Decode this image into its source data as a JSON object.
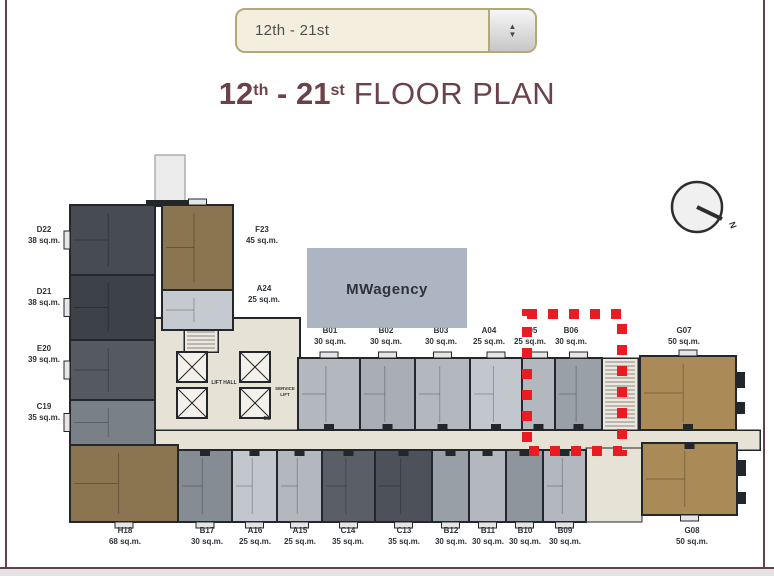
{
  "selector": {
    "value": "12th - 21st",
    "up_icon": "▲",
    "down_icon": "▼"
  },
  "title": {
    "bold_1": "12",
    "sup_1": "th",
    "dash": " - ",
    "bold_2": "21",
    "sup_2": "st",
    "regular": "FLOOR PLAN"
  },
  "watermark": {
    "x": 307,
    "y": 248,
    "w": 160,
    "h": 80,
    "text": "MWagency",
    "fill": "#a8afbd",
    "text_color": "#ffffff"
  },
  "compass": {
    "cx": 697,
    "cy": 207,
    "r": 25,
    "nx": 722,
    "ny": 219,
    "label": "N",
    "label_x": 730,
    "label_y": 226,
    "label_rot": 70
  },
  "colors": {
    "wall": "#23262b",
    "core": "#e7e2d6",
    "stair_bg": "#ece8dd",
    "bump": "#e6e6e6",
    "highlight": "#ec1a21",
    "accent_maroon": "#6d4149",
    "dropdown_border": "#b4a77c"
  },
  "floor_plan": {
    "core": {
      "x": 150,
      "y": 318,
      "w": 150,
      "h": 134
    },
    "corridor": {
      "x": 150,
      "y": 430,
      "w": 610,
      "h": 20
    },
    "open_area": {
      "x": 586,
      "y": 448,
      "w": 56,
      "h": 74
    },
    "stairs": [
      {
        "x": 184,
        "y": 320,
        "w": 34,
        "h": 32
      },
      {
        "x": 602,
        "y": 358,
        "w": 36,
        "h": 72
      }
    ],
    "lifts": [
      {
        "x": 177,
        "y": 352
      },
      {
        "x": 177,
        "y": 388
      },
      {
        "x": 240,
        "y": 352
      },
      {
        "x": 240,
        "y": 388
      }
    ],
    "lift_size": 30,
    "core_labels": [
      {
        "text": "LIFT HALL",
        "x": 224,
        "y": 384,
        "size": 5
      },
      {
        "text": "SERVICE",
        "x": 285,
        "y": 390,
        "size": 4.5
      },
      {
        "text": "LIFT",
        "x": 285,
        "y": 396,
        "size": 4.5
      },
      {
        "text": "GB",
        "x": 267,
        "y": 420,
        "size": 5
      }
    ],
    "units": [
      {
        "id": "D22",
        "area": "38 sq.m.",
        "x": 70,
        "y": 205,
        "w": 85,
        "h": 70,
        "fill": "#474b52",
        "lx": 44,
        "ly": 232,
        "edge": "l"
      },
      {
        "id": "D21",
        "area": "38 sq.m.",
        "x": 70,
        "y": 275,
        "w": 85,
        "h": 65,
        "fill": "#3d4148",
        "lx": 44,
        "ly": 294,
        "edge": "l"
      },
      {
        "id": "E20",
        "area": "39 sq.m.",
        "x": 70,
        "y": 340,
        "w": 85,
        "h": 60,
        "fill": "#555a61",
        "lx": 44,
        "ly": 351,
        "edge": "l"
      },
      {
        "id": "C19",
        "area": "35 sq.m.",
        "x": 70,
        "y": 400,
        "w": 85,
        "h": 45,
        "fill": "#7a8088",
        "lx": 44,
        "ly": 409,
        "edge": "l"
      },
      {
        "id": "H18",
        "area": "68 sq.m.",
        "x": 70,
        "y": 445,
        "w": 108,
        "h": 77,
        "fill": "#8b7450",
        "lx": 125,
        "ly": 533,
        "edge": "b"
      },
      {
        "id": "F23",
        "area": "45 sq.m.",
        "x": 162,
        "y": 205,
        "w": 71,
        "h": 85,
        "fill": "#8b7450",
        "lx": 262,
        "ly": 232,
        "edge": "t"
      },
      {
        "id": "A24",
        "area": "25 sq.m.",
        "x": 162,
        "y": 290,
        "w": 71,
        "h": 40,
        "fill": "#c5cad0",
        "lx": 264,
        "ly": 291,
        "edge": ""
      },
      {
        "id": "B01",
        "area": "30 sq.m.",
        "x": 298,
        "y": 358,
        "w": 62,
        "h": 72,
        "fill": "#b3b8bf",
        "lx": 330,
        "ly": 333,
        "edge": "t",
        "door": "d"
      },
      {
        "id": "B02",
        "area": "30 sq.m.",
        "x": 360,
        "y": 358,
        "w": 55,
        "h": 72,
        "fill": "#a9aeb6",
        "lx": 386,
        "ly": 333,
        "edge": "t",
        "door": "d"
      },
      {
        "id": "B03",
        "area": "30 sq.m.",
        "x": 415,
        "y": 358,
        "w": 55,
        "h": 72,
        "fill": "#b3b8bf",
        "lx": 441,
        "ly": 333,
        "edge": "t",
        "door": "d"
      },
      {
        "id": "A04",
        "area": "25 sq.m.",
        "x": 470,
        "y": 358,
        "w": 52,
        "h": 72,
        "fill": "#c2c7cd",
        "lx": 489,
        "ly": 333,
        "edge": "t",
        "door": "d"
      },
      {
        "id": "A05",
        "area": "25 sq.m.",
        "x": 522,
        "y": 358,
        "w": 33,
        "h": 72,
        "fill": "#b3b8bf",
        "lx": 530,
        "ly": 333,
        "edge": "t",
        "door": "d"
      },
      {
        "id": "B06",
        "area": "30 sq.m.",
        "x": 555,
        "y": 358,
        "w": 47,
        "h": 72,
        "fill": "#9aa0a8",
        "lx": 571,
        "ly": 333,
        "edge": "t",
        "door": "d"
      },
      {
        "id": "G07",
        "area": "50 sq.m.",
        "x": 640,
        "y": 356,
        "w": 96,
        "h": 74,
        "fill": "#aa8a57",
        "lx": 684,
        "ly": 333,
        "edge": "t",
        "door": "d"
      },
      {
        "id": "B17",
        "area": "30 sq.m.",
        "x": 178,
        "y": 450,
        "w": 54,
        "h": 72,
        "fill": "#868c94",
        "lx": 207,
        "ly": 533,
        "edge": "b",
        "door": "u"
      },
      {
        "id": "A16",
        "area": "25 sq.m.",
        "x": 232,
        "y": 450,
        "w": 45,
        "h": 72,
        "fill": "#c2c7cd",
        "lx": 255,
        "ly": 533,
        "edge": "b",
        "door": "u"
      },
      {
        "id": "A15",
        "area": "25 sq.m.",
        "x": 277,
        "y": 450,
        "w": 45,
        "h": 72,
        "fill": "#b3b8bf",
        "lx": 300,
        "ly": 533,
        "edge": "b",
        "door": "u"
      },
      {
        "id": "C14",
        "area": "35 sq.m.",
        "x": 322,
        "y": 450,
        "w": 53,
        "h": 72,
        "fill": "#5a5f67",
        "lx": 348,
        "ly": 533,
        "edge": "b",
        "door": "u"
      },
      {
        "id": "C13",
        "area": "35 sq.m.",
        "x": 375,
        "y": 450,
        "w": 57,
        "h": 72,
        "fill": "#4d525a",
        "lx": 404,
        "ly": 533,
        "edge": "b",
        "door": "u"
      },
      {
        "id": "B12",
        "area": "30 sq.m.",
        "x": 432,
        "y": 450,
        "w": 37,
        "h": 72,
        "fill": "#999fa7",
        "lx": 451,
        "ly": 533,
        "edge": "b",
        "door": "u"
      },
      {
        "id": "B11",
        "area": "30 sq.m.",
        "x": 469,
        "y": 450,
        "w": 37,
        "h": 72,
        "fill": "#b3b8bf",
        "lx": 488,
        "ly": 533,
        "edge": "b",
        "door": "u"
      },
      {
        "id": "B10",
        "area": "30 sq.m.",
        "x": 506,
        "y": 450,
        "w": 37,
        "h": 72,
        "fill": "#8f959d",
        "lx": 525,
        "ly": 533,
        "edge": "b",
        "door": "u"
      },
      {
        "id": "B09",
        "area": "30 sq.m.",
        "x": 543,
        "y": 450,
        "w": 43,
        "h": 72,
        "fill": "#b3b8bf",
        "lx": 565,
        "ly": 533,
        "edge": "b",
        "door": "u"
      },
      {
        "id": "G08",
        "area": "50 sq.m.",
        "x": 642,
        "y": 443,
        "w": 95,
        "h": 72,
        "fill": "#aa8a57",
        "lx": 692,
        "ly": 533,
        "edge": "b",
        "door": "u"
      }
    ],
    "decorations": [
      {
        "x": 155,
        "y": 155,
        "w": 30,
        "h": 48,
        "fill": "#ececec",
        "stroke": "#8a8a8a"
      },
      {
        "x": 146,
        "y": 200,
        "w": 52,
        "h": 7,
        "fill": "#23262b"
      },
      {
        "x": 736,
        "y": 372,
        "w": 9,
        "h": 16,
        "fill": "#23262b"
      },
      {
        "x": 736,
        "y": 402,
        "w": 9,
        "h": 12,
        "fill": "#23262b"
      },
      {
        "x": 737,
        "y": 460,
        "w": 9,
        "h": 16,
        "fill": "#23262b"
      },
      {
        "x": 737,
        "y": 492,
        "w": 9,
        "h": 12,
        "fill": "#23262b"
      }
    ],
    "highlight": {
      "x": 527,
      "y": 314,
      "w": 95,
      "h": 137
    }
  }
}
